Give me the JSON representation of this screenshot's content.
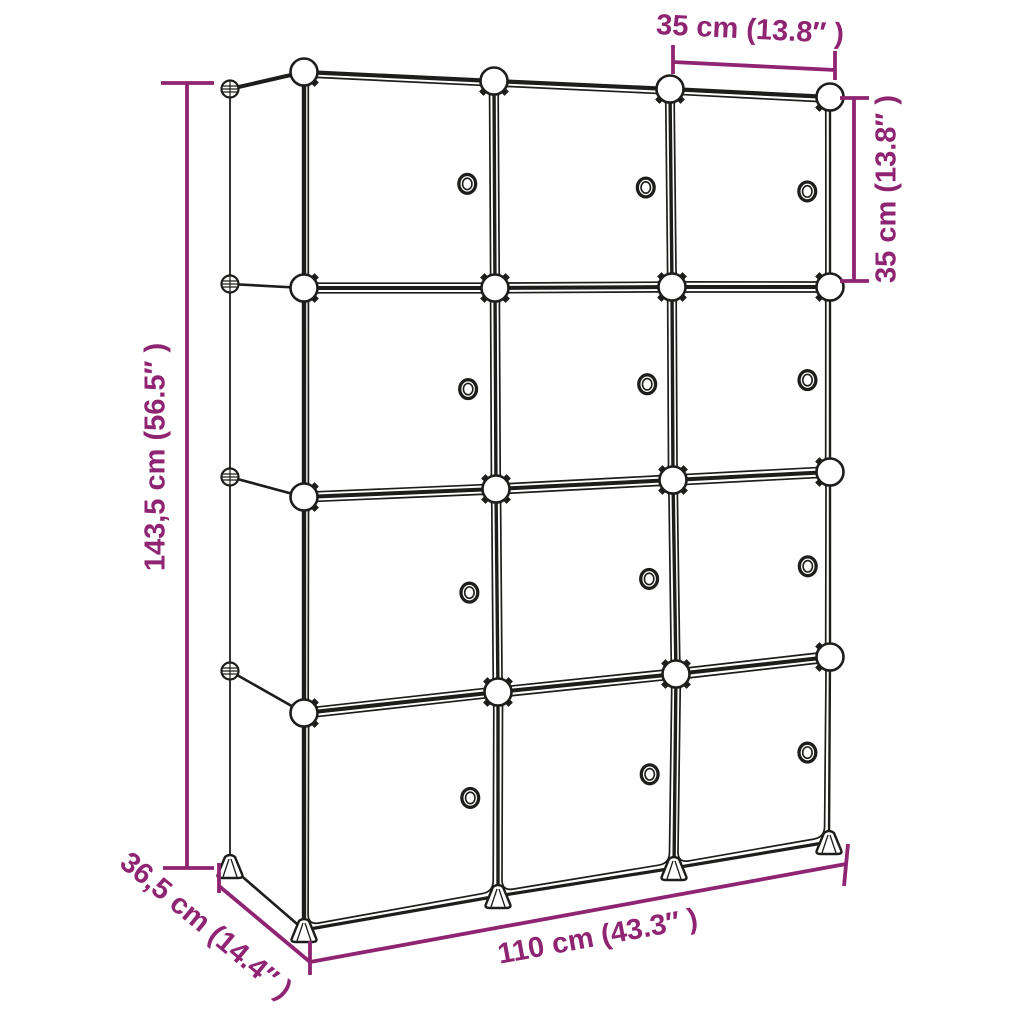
{
  "diagram": {
    "grid": {
      "columns": 3,
      "rows": 4,
      "cube_count": 12,
      "door_count": 12
    },
    "colors": {
      "dimension_accent": "#8f2472",
      "outline": "#1d1d1b",
      "panel_fill": "#ffffff",
      "background": "#ffffff"
    },
    "dimensions": {
      "cube_width_top": {
        "label": "35 cm (13.8″ )"
      },
      "cube_height_right": {
        "label": "35 cm (13.8″ )"
      },
      "total_height_left": {
        "label": "143,5 cm (56.5″ )"
      },
      "depth_bottom_left": {
        "label": "36,5 cm (14.4″ )"
      },
      "total_width_bottom": {
        "label": "110 cm (43.3″ )"
      }
    }
  }
}
